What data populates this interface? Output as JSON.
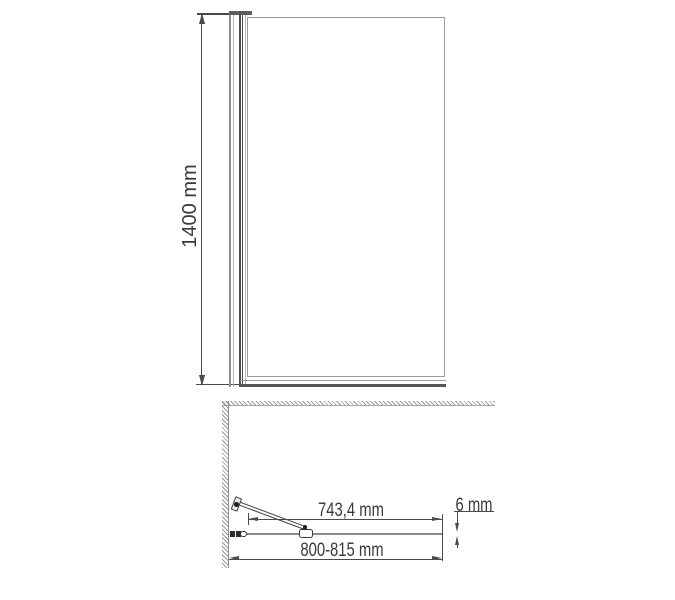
{
  "drawing": {
    "type": "technical-drawing",
    "subject": "bath screen / shower glass panel, front view and plan view"
  },
  "front_view": {
    "height_label": "1400 mm"
  },
  "plan_view": {
    "bar_reach_label": "743,4 mm",
    "width_range_label": "800-815 mm",
    "glass_thickness_label": "6 mm"
  },
  "colors": {
    "background": "#ffffff",
    "dimension_line": "#4a4a4a",
    "text": "#3a3a3a",
    "glass_outline": "#9b9b9b",
    "profile_dark": "#4c4c4c",
    "hatch": "#9a9a9a"
  }
}
